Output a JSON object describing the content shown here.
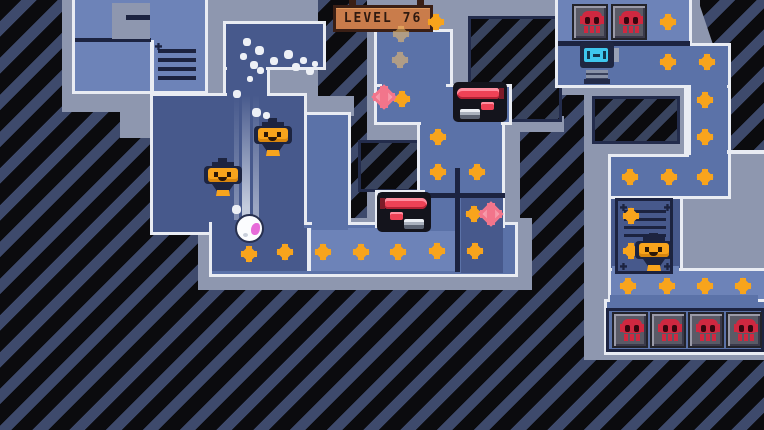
{
  "hud": {
    "level_label": "LEVEL 76"
  },
  "colors": {
    "bg_black": "#0b0b0e",
    "bg_stripe": "#3e4a6c",
    "wall": "#8e97af",
    "floor_light": "#6d83b8",
    "floor_mid": "#5b72a8",
    "floor_dark": "#47598c",
    "border_white": "#e9ecf3",
    "navy": "#1c2340",
    "gem_orange": "#f8a41c",
    "gem_pink": "#f2758b",
    "skull_red": "#cf2840",
    "robot_screen_cyan": "#3ec7ee",
    "machine_red": "#ee4256",
    "sign_bg": "#c97c4b",
    "sign_text": "#2f1a10"
  },
  "sprites": {
    "diamonds_orange": [
      [
        436,
        22
      ],
      [
        402,
        99
      ],
      [
        438,
        137
      ],
      [
        438,
        172
      ],
      [
        477,
        172
      ],
      [
        474,
        214
      ],
      [
        249,
        254
      ],
      [
        285,
        252
      ],
      [
        323,
        252
      ],
      [
        361,
        252
      ],
      [
        398,
        252
      ],
      [
        437,
        251
      ],
      [
        475,
        251
      ],
      [
        668,
        22
      ],
      [
        668,
        62
      ],
      [
        707,
        62
      ],
      [
        705,
        100
      ],
      [
        705,
        137
      ],
      [
        630,
        177
      ],
      [
        669,
        177
      ],
      [
        705,
        177
      ],
      [
        631,
        216
      ],
      [
        631,
        251
      ],
      [
        628,
        286
      ],
      [
        667,
        286
      ],
      [
        705,
        286
      ],
      [
        743,
        286
      ]
    ],
    "diamonds_dim": [
      [
        401,
        34
      ],
      [
        400,
        60
      ]
    ],
    "diamonds_pink": [
      [
        384,
        97
      ],
      [
        491,
        214
      ]
    ],
    "skull_tiles": [
      [
        572,
        4
      ],
      [
        611,
        4
      ],
      [
        612,
        312
      ],
      [
        650,
        312
      ],
      [
        688,
        312
      ],
      [
        726,
        312
      ]
    ],
    "lanterns": [
      [
        203,
        158
      ],
      [
        253,
        118
      ],
      [
        634,
        233
      ]
    ],
    "machines": [
      {
        "x": 453,
        "y": 82,
        "flip": false
      },
      {
        "x": 377,
        "y": 192,
        "flip": true
      }
    ],
    "robot": {
      "x": 579,
      "y": 40
    },
    "ball": {
      "x": 235,
      "y": 214
    },
    "trail": {
      "x": 234,
      "y": 95,
      "h": 125
    },
    "particles": [
      [
        243,
        38,
        8
      ],
      [
        255,
        46,
        9
      ],
      [
        240,
        53,
        7
      ],
      [
        250,
        61,
        8
      ],
      [
        257,
        67,
        7
      ],
      [
        270,
        57,
        8
      ],
      [
        284,
        50,
        9
      ],
      [
        292,
        63,
        8
      ],
      [
        300,
        57,
        7
      ],
      [
        306,
        67,
        8
      ],
      [
        312,
        61,
        6
      ],
      [
        247,
        76,
        6
      ],
      [
        233,
        90,
        8
      ],
      [
        252,
        108,
        9
      ],
      [
        263,
        112,
        7
      ],
      [
        232,
        205,
        9
      ]
    ]
  }
}
